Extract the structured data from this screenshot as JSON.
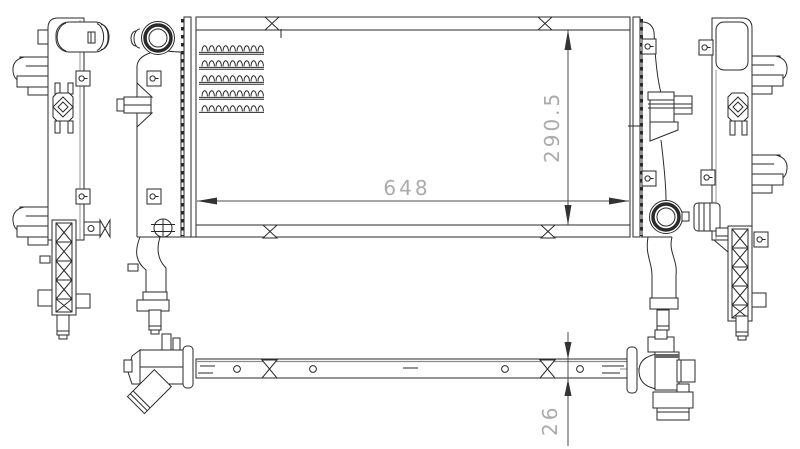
{
  "drawing": {
    "dimensions": {
      "width": "648",
      "height": "290.5",
      "thickness": "26"
    },
    "colors": {
      "background": "#ffffff",
      "line": "#2a2a2a",
      "dimension_line": "#4d4d4d",
      "dimension_text": "#ababab"
    }
  }
}
